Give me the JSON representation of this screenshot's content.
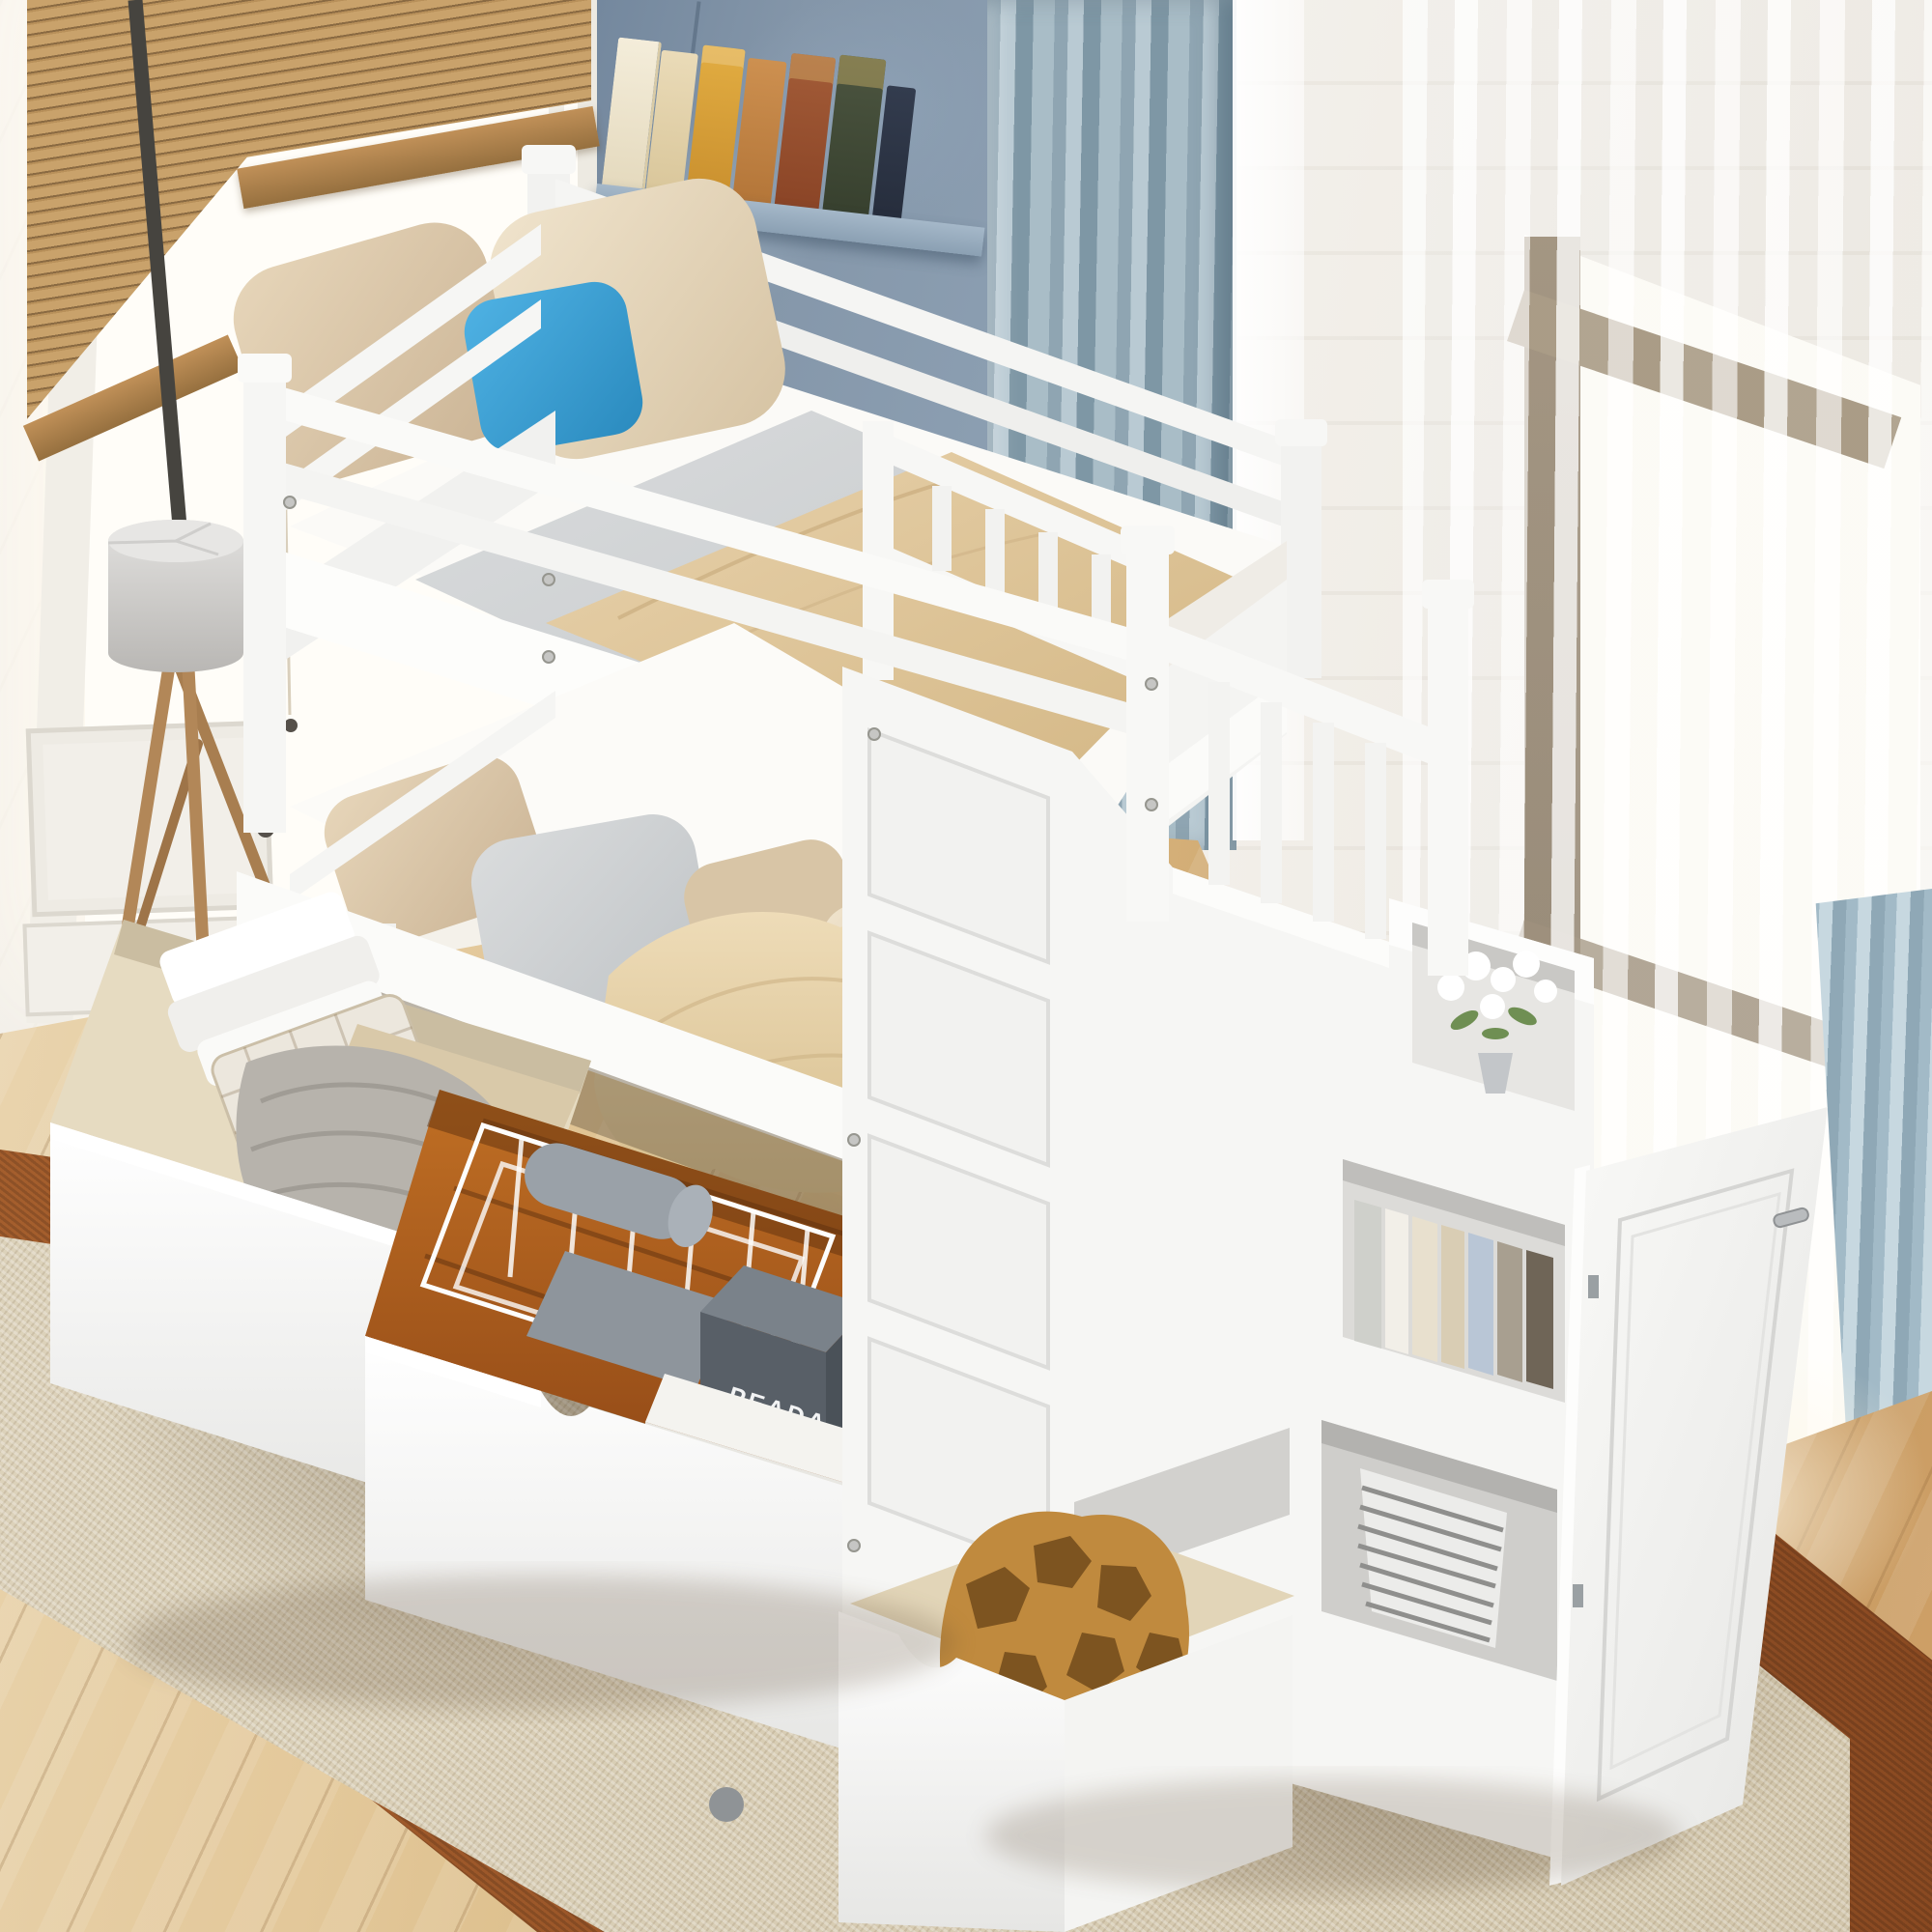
{
  "scene": {
    "type": "furniture product photo",
    "description": "White wood twin-over-twin bunk bed with guard rails, storage staircase with shelves and cabinet, two rolling under-bed storage drawers pulled open, photographed in a bright bedroom",
    "room_features": [
      "left window with bamboo venetian blind",
      "blue corner bookshelf with antique books and gold candlesticks",
      "white wainscoting wall",
      "slate-blue drape curtain",
      "sheer white curtains over right window",
      "light oak plank floor",
      "beige area rug with rust-brown border",
      "wooden tripod floor lamp with gray drum shade"
    ]
  },
  "bed": {
    "color_name": "white",
    "upper_bunk": [
      "two beige pillows",
      "one blue throw pillow",
      "gray sheet",
      "tan blanket",
      "two-bar guard rails"
    ],
    "lower_bunk": [
      "beige and gray pillows",
      "white fitted sheet",
      "crumpled tan throw"
    ],
    "staircase": [
      "stair railing with balusters",
      "flower cubby",
      "book cubby",
      "wicker basket cubby",
      "open cabinet door",
      "small stair drawer with giraffe-print fabric"
    ]
  },
  "drawers": {
    "drawer_a_contents": [
      "folded white towels",
      "checked storage basket",
      "gray chunky-knit blanket",
      "tan folded blanket"
    ],
    "drawer_b_contents": [
      "white wire basket",
      "gray waffle towels",
      "dark gray gift box",
      "white art book"
    ]
  },
  "objects": {
    "prada_box": {
      "label": "PEADA",
      "color": "#585f67"
    },
    "book": {
      "label": "ROBERT LONGO",
      "color": "#f4f3ef"
    }
  },
  "palette": {
    "bed_white": "#f7f7f5",
    "pillow_beige": "#dcc9ab",
    "pillow_blue": "#3da3d8",
    "blanket_tan": "#ddc49c",
    "sheet_gray": "#d3d5d6",
    "curtain_slate_blue": "#8fa5b2",
    "niche_blue": "#8496a9",
    "blind_bamboo": "#b8905a",
    "floor_oak": "#d9b983",
    "rug_field_beige": "#d6cbb2",
    "rug_border_rust": "#9c5a2b",
    "drawer_interior_wood": "#a8571e",
    "lamp_shade_gray": "#cfcecc",
    "lamp_legs_wood": "#b28758"
  }
}
